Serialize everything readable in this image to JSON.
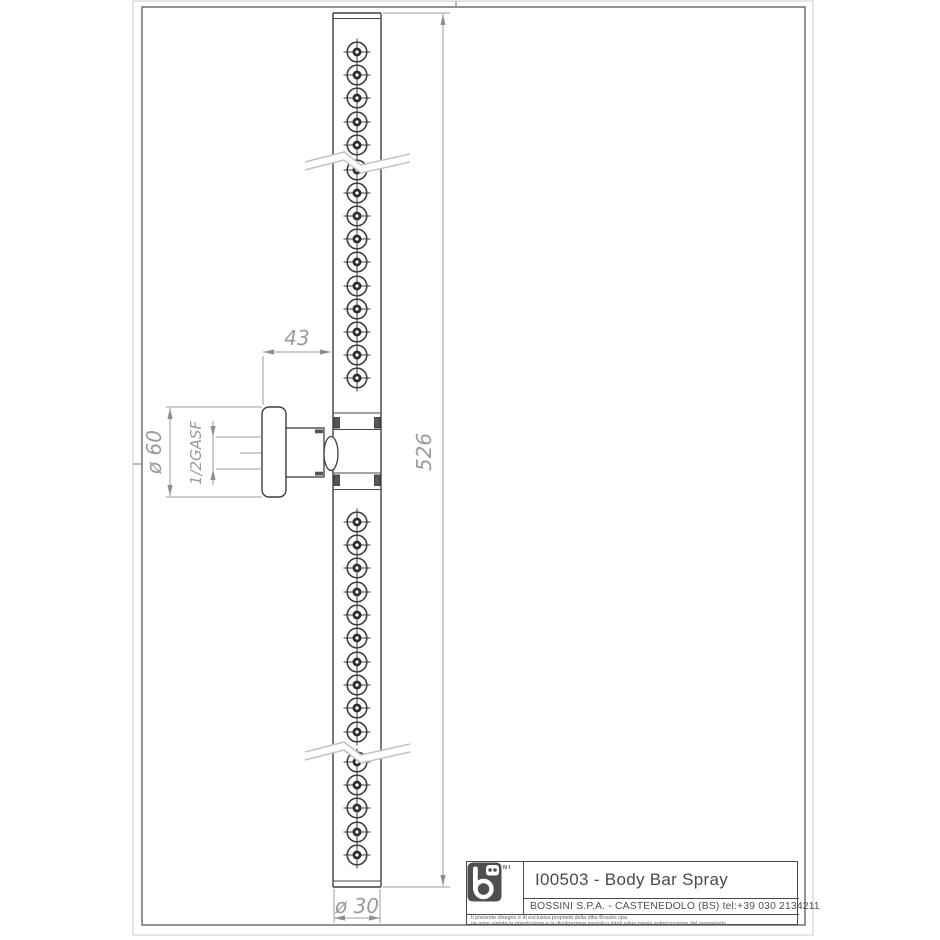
{
  "title_block": {
    "logo_word": "BOSSINI",
    "drawing_title": "I00503 - Body Bar Spray",
    "company_line": "BOSSINI S.P.A. - CASTENEDOLO (BS) tel:+39 030 2134211",
    "disclaimer_line1": "Il presente disegno è di esclusiva proprietà della ditta Bossini spa",
    "disclaimer_line2": "ne sono vietate la riproduzione e la divulgazione parziali o totali salvo previa autorizzazione del proprietario."
  },
  "dimensions": {
    "wall_offset": "43",
    "bar_length": "526",
    "bar_diameter": "ø 30",
    "flange_diameter": "ø 60",
    "thread": "1/2GASF"
  },
  "diagram": {
    "description": "Technical drawing of body bar spray: vertical spray bar with nozzles, wall mount flange, break symbols",
    "nozzle_cx": 357,
    "nozzle_ys": [
      52,
      75,
      98,
      122,
      145,
      170,
      193,
      216,
      239,
      262,
      286,
      309,
      332,
      355,
      378,
      522,
      545,
      568,
      592,
      615,
      638,
      662,
      685,
      708,
      732,
      762,
      785,
      808,
      832,
      855
    ],
    "colors": {
      "object_line": "#3e3e3e",
      "dimension_line": "#9b9b9b",
      "break_line": "#c2c2c2",
      "frame": "#5a5a5a",
      "paper_border": "#cccccc"
    }
  }
}
